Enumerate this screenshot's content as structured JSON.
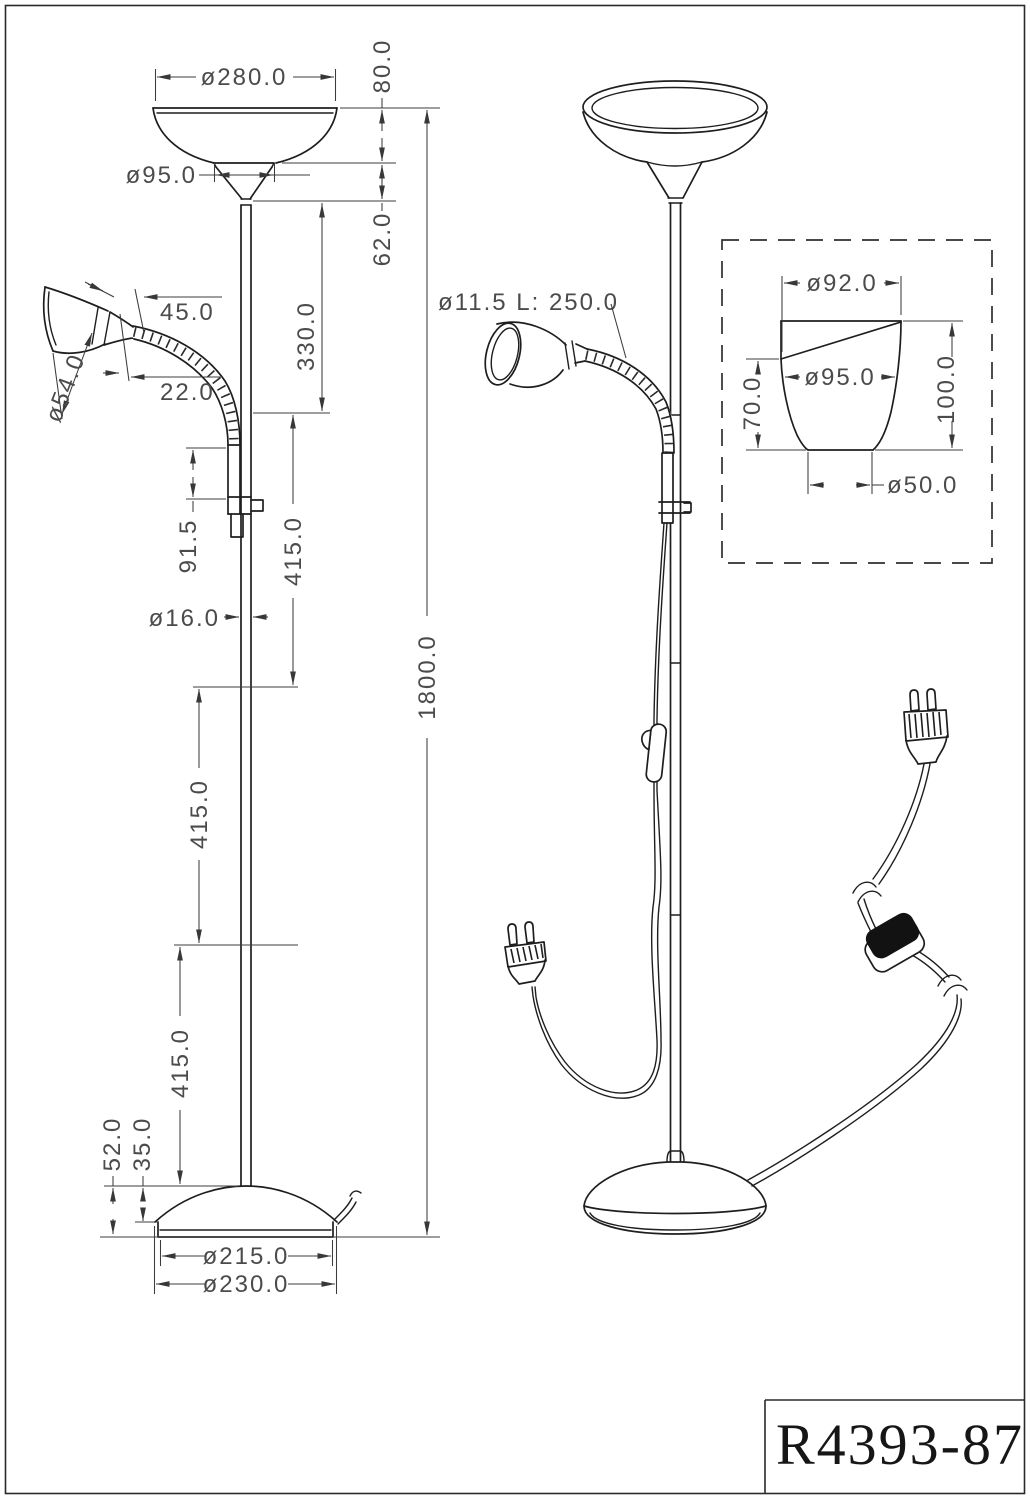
{
  "title_block": {
    "part_number": "R4393-87"
  },
  "left_view": {
    "dim_shade_diameter": "ø280.0",
    "dim_shade_height": "80.0",
    "dim_neck_diameter": "ø95.0",
    "dim_funnel_height": "62.0",
    "dim_upper_segment": "330.0",
    "dim_spot_shade_length": "45.0",
    "dim_spot_neck_length": "22.0",
    "dim_spot_shade_diameter": "ø54.0",
    "dim_holder_length": "91.5",
    "dim_pole_segment_1": "415.0",
    "dim_pole_segment_2": "415.0",
    "dim_pole_segment_3": "415.0",
    "dim_pole_diameter": "ø16.0",
    "dim_total_height": "1800.0",
    "dim_base_height": "52.0",
    "dim_base_dome_height": "35.0",
    "dim_base_top_diameter": "ø215.0",
    "dim_base_diameter": "ø230.0"
  },
  "right_view": {
    "flex_arm_note": "ø11.5 L: 250.0"
  },
  "detail_view": {
    "dim_top_diameter": "ø92.0",
    "dim_max_diameter": "ø95.0",
    "dim_front_height": "70.0",
    "dim_total_height": "100.0",
    "dim_bottom_diameter": "ø50.0"
  },
  "colors": {
    "line": "#1e1e1e",
    "dim_line": "#3c3c3c",
    "text": "#4b4b4b",
    "fill_black": "#121212"
  }
}
